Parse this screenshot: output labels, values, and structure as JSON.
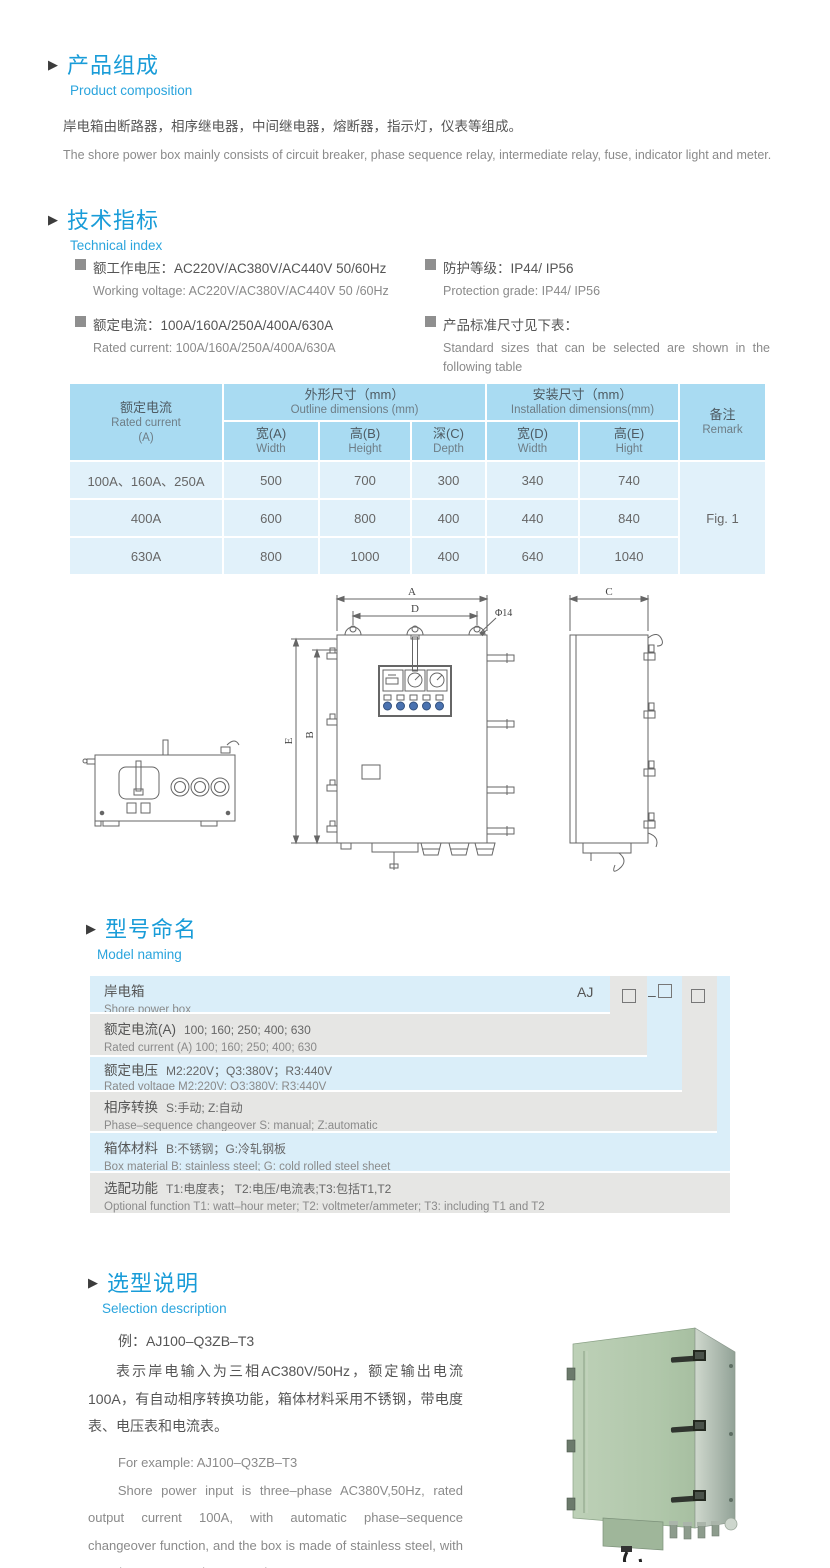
{
  "ui": {
    "arrow_glyph": "▶"
  },
  "composition": {
    "title_cn": "产品组成",
    "title_en": "Product  composition",
    "body_cn": "岸电箱由断路器，相序继电器，中间继电器，熔断器，指示灯，仪表等组成。",
    "body_en": "The shore power box mainly consists of circuit breaker, phase sequence relay, intermediate relay, fuse, indicator light and meter."
  },
  "technical": {
    "title_cn": "技术指标",
    "title_en": "Technical index",
    "left": [
      {
        "cn": "额工作电压：AC220V/AC380V/AC440V  50/60Hz",
        "en": "Working voltage: AC220V/AC380V/AC440V 50 /60Hz"
      },
      {
        "cn": "额定电流：100A/160A/250A/400A/630A",
        "en": "Rated current: 100A/160A/250A/400A/630A"
      }
    ],
    "right": [
      {
        "cn": "防护等级：IP44/ IP56",
        "en": "Protection grade: IP44/ IP56"
      },
      {
        "cn": "产品标准尺寸见下表：",
        "en": "Standard sizes that can be selected are shown in the following table"
      }
    ]
  },
  "size_table": {
    "rated_current_cn": "额定电流",
    "rated_current_en": "Rated current",
    "rated_current_unit": "(A)",
    "outline_cn": "外形尺寸（mm）",
    "outline_en": "Outline dimensions (mm)",
    "install_cn": "安装尺寸（mm）",
    "install_en": "Installation dimensions(mm)",
    "remark_cn": "备注",
    "remark_en": "Remark",
    "sub_headers": [
      {
        "cn": "宽(A)",
        "en": "Width"
      },
      {
        "cn": "高(B)",
        "en": "Height"
      },
      {
        "cn": "深(C)",
        "en": "Depth"
      },
      {
        "cn": "宽(D)",
        "en": "Width"
      },
      {
        "cn": "高(E)",
        "en": "Hight"
      }
    ],
    "rows": [
      {
        "current": "100A、160A、250A",
        "width": "500",
        "height": "700",
        "depth": "300",
        "iwidth": "340",
        "iheight": "740"
      },
      {
        "current": "400A",
        "width": "600",
        "height": "800",
        "depth": "400",
        "iwidth": "440",
        "iheight": "840"
      },
      {
        "current": "630A",
        "width": "800",
        "height": "1000",
        "depth": "400",
        "iwidth": "640",
        "iheight": "1040"
      }
    ],
    "remark_value": "Fig. 1"
  },
  "drawing": {
    "dim_a": "A",
    "dim_b": "B",
    "dim_c": "C",
    "dim_d": "D",
    "dim_e": "E",
    "hole_label": "Φ14"
  },
  "model_naming": {
    "title_cn": "型号命名",
    "title_en": "Model naming",
    "code_prefix": "AJ",
    "code_dash": "–",
    "code_box": "",
    "rows": [
      {
        "label_cn": "岸电箱",
        "value_cn": "",
        "en": "Shore power box"
      },
      {
        "label_cn": "额定电流(A)",
        "value_cn": "100; 160; 250; 400; 630",
        "en": "Rated current (A) 100; 160; 250; 400; 630"
      },
      {
        "label_cn": "额定电压",
        "value_cn": "M2:220V；Q3:380V；R3:440V",
        "en": "Rated voltage  M2:220V;  Q3:380V;  R3:440V"
      },
      {
        "label_cn": "相序转换",
        "value_cn": "S:手动; Z:自动",
        "en": "Phase–sequence changeover  S: manual;  Z:automatic"
      },
      {
        "label_cn": "箱体材料",
        "value_cn": "B:不锈钢；G:冷轧钢板",
        "en": "Box material   B: stainless steel; G: cold rolled steel sheet"
      },
      {
        "label_cn": "选配功能",
        "value_cn": "T1:电度表； T2:电压/电流表;T3:包括T1,T2",
        "en": "Optional function  T1: watt–hour meter; T2: voltmeter/ammeter; T3: including T1 and T2"
      }
    ]
  },
  "selection": {
    "title_cn": "选型说明",
    "title_en": "Selection description",
    "example_cn": "例：AJ100–Q3ZB–T3",
    "desc_cn": "表示岸电输入为三相AC380V/50Hz，额定输出电流100A，有自动相序转换功能，箱体材料采用不锈钢，带电度表、电压表和电流表。",
    "example_en": "For example: AJ100–Q3ZB–T3",
    "desc_en": "Shore power input is three–phase AC380V,50Hz, rated output current 100A, with automatic phase–sequence changeover function, and the box is made of stainless steel, with watt–hour meter, voltmeter and ammeter."
  }
}
